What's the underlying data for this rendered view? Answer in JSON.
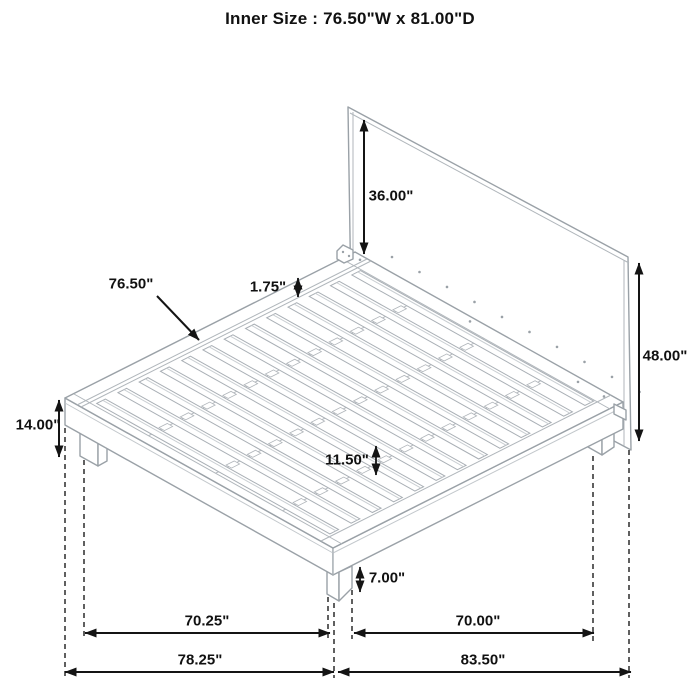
{
  "title": "Inner Size : 76.50\"W x 81.00\"D",
  "dimensions": {
    "headboard_above_platform": "36.00\"",
    "headboard_total_height": "48.00\"",
    "platform_height": "14.00\"",
    "slat_length": "76.50\"",
    "slat_thickness": "1.75\"",
    "slat_gap": "11.50\"",
    "leg_height": "7.00\"",
    "leg_span_width": "70.25\"",
    "overall_width": "78.25\"",
    "leg_span_depth": "70.00\"",
    "overall_depth": "83.50\""
  },
  "colors": {
    "dimension_line": "#141414",
    "artwork_line": "#9aa1a7",
    "background": "#ffffff"
  }
}
